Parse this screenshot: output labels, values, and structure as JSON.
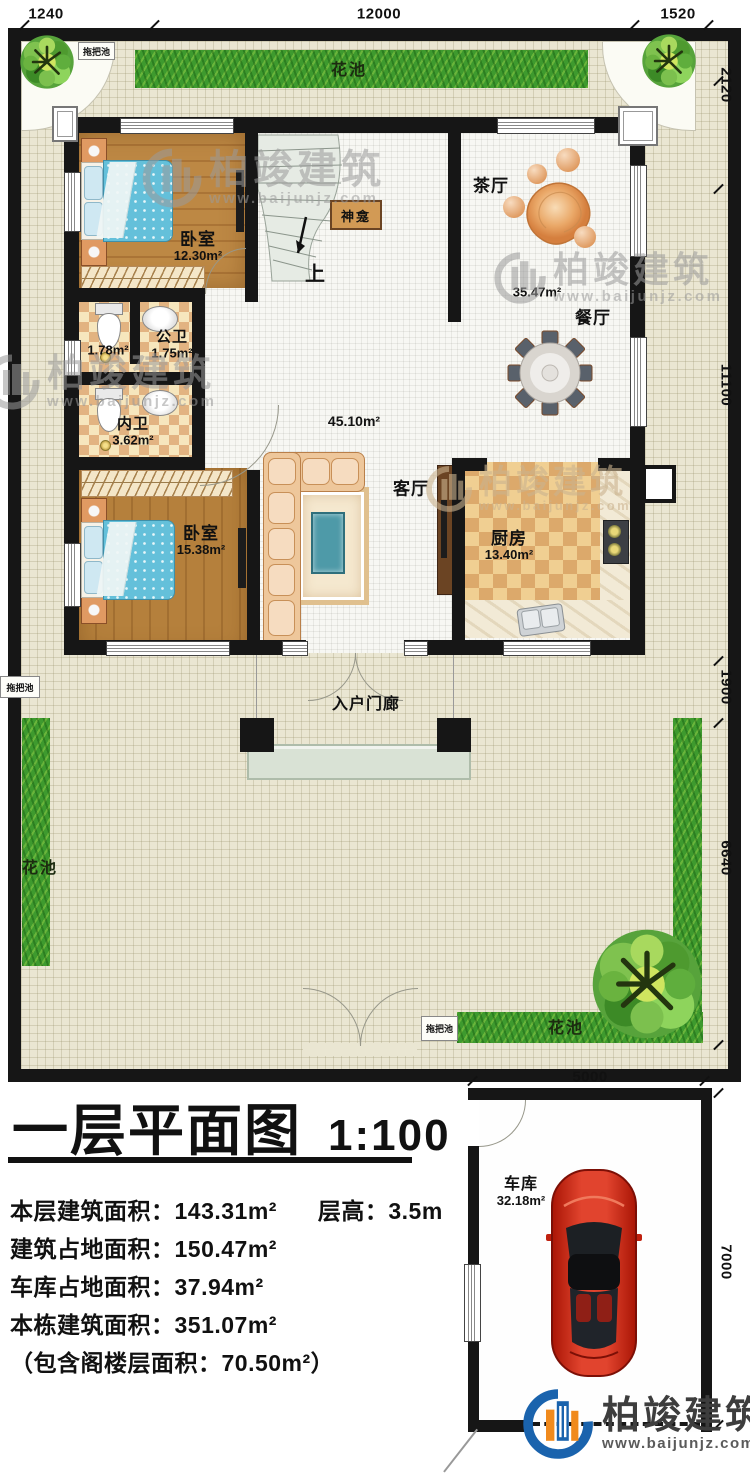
{
  "branding": {
    "company": "柏竣建筑",
    "website": "www.baijunjz.com"
  },
  "dims": {
    "top_left": "1240",
    "top_mid": "12000",
    "top_right": "1520",
    "right_top": "2120",
    "right_mid": "11100",
    "right_lower": "1900",
    "right_bottom": "6640",
    "garage_width": "5000",
    "garage_height": "7000"
  },
  "yard": {
    "flower_bed": "花池",
    "mop_sink": "拖把池"
  },
  "rooms": {
    "bedroom1": {
      "name": "卧室",
      "area": "12.30m²"
    },
    "public_bath": {
      "name": "公卫",
      "area": "1.75m²",
      "stall_area": "1.78m²"
    },
    "private_bath": {
      "name": "内卫",
      "area": "3.62m²"
    },
    "bedroom2": {
      "name": "卧室",
      "area": "15.38m²"
    },
    "living": {
      "name": "客厅",
      "area": "45.10m²"
    },
    "tea_hall": {
      "name": "茶厅"
    },
    "dining": {
      "name": "餐厅",
      "area": "35.47m²"
    },
    "kitchen": {
      "name": "厨房",
      "area": "13.40m²"
    },
    "porch": {
      "name": "入户门廊"
    },
    "shrine": {
      "name": "神龛"
    },
    "stair": {
      "up": "上"
    },
    "garage": {
      "name": "车库",
      "area": "32.18m²"
    }
  },
  "title_block": {
    "title": "一层平面图",
    "scale": "1:100",
    "stats": [
      {
        "left": "本层建筑面积：143.31m²",
        "right": "层高：3.5m"
      },
      {
        "left": "建筑占地面积：150.47m²",
        "right": ""
      },
      {
        "left": "车库占地面积：37.94m²",
        "right": ""
      },
      {
        "left": "本栋建筑面积：351.07m²",
        "right": ""
      },
      {
        "left": "（包含阁楼层面积：70.50m²）",
        "right": ""
      }
    ]
  }
}
